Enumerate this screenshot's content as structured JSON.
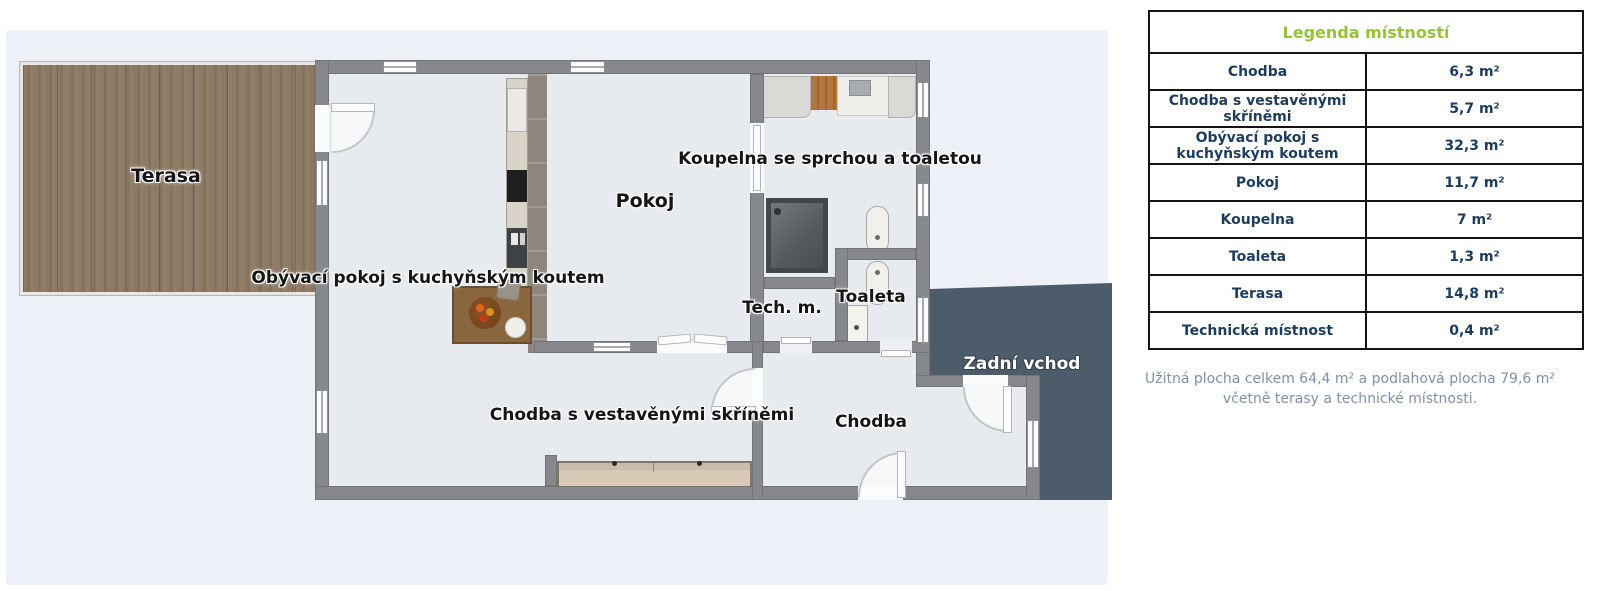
{
  "plan": {
    "labels": {
      "terasa": "Terasa",
      "obyvaci_pokoj": "Obývací pokoj s kuchyňským koutem",
      "pokoj": "Pokoj",
      "koupelna": "Koupelna se sprchou a toaletou",
      "tech_m": "Tech. m.",
      "toaleta": "Toaleta",
      "chodba_vestavene": "Chodba s vestavěnými skříněmi",
      "chodba": "Chodba",
      "zadni_vchod": "Zadní vchod"
    }
  },
  "legend": {
    "title": "Legenda místností",
    "rows": [
      {
        "name": "Chodba",
        "area": "6,3 m²"
      },
      {
        "name": "Chodba s vestavěnými skříněmi",
        "area": "5,7 m²"
      },
      {
        "name": "Obývací pokoj s kuchyňským koutem",
        "area": "32,3 m²"
      },
      {
        "name": "Pokoj",
        "area": "11,7 m²"
      },
      {
        "name": "Koupelna",
        "area": "7 m²"
      },
      {
        "name": "Toaleta",
        "area": "1,3 m²"
      },
      {
        "name": "Terasa",
        "area": "14,8 m²"
      },
      {
        "name": "Technická místnost",
        "area": "0,4 m²"
      }
    ],
    "footer_line1": "Užitná plocha celkem 64,4 m² a podlahová plocha 79,6 m²",
    "footer_line2": "včetně terasy a technické místnosti.",
    "title_color": "#97c23c",
    "text_color": "#1d3c5e"
  },
  "colors": {
    "wall_gray": "#87888c",
    "floor": "#e7eaee",
    "terrace_wood": "#8b7964",
    "deck_dark": "#4d5c6a"
  }
}
